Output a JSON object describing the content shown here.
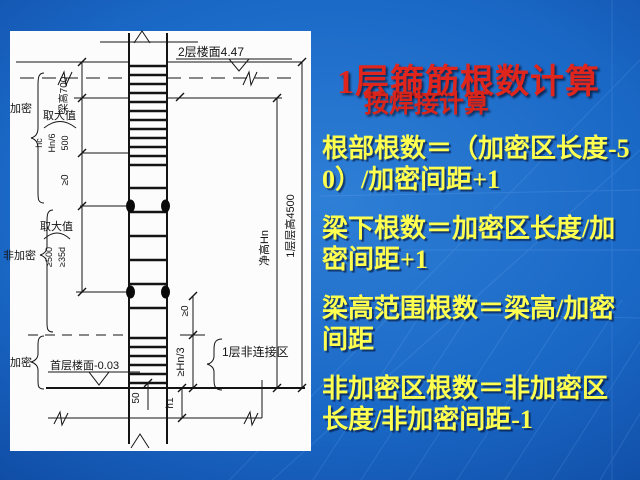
{
  "slide": {
    "title": "1层箍筋根数计算",
    "subtitle": "按焊接计算",
    "paragraphs": [
      "根部根数＝（加密区长度-50）/加密间距+1",
      "梁下根数＝加密区长度/加密间距+1",
      "梁高范围根数＝梁高/加密间距",
      "非加密区根数＝非加密区长度/非加密间距-1"
    ],
    "colors": {
      "background": "#1a68c6",
      "title_red": "#e0261c",
      "body_yellow": "#ffff4f",
      "panel_white": "#fcfcfc",
      "line_black": "#141414"
    }
  },
  "diagram": {
    "labels": {
      "floor2_level": "2层楼面4.47",
      "beam_height": "梁高700",
      "dense_top": "加密",
      "take_max_top": "取大值",
      "hc": "hc",
      "hn6": "Hn/6",
      "v500": "500",
      "ge0_left": "≥0",
      "non_dense": "非加密",
      "take_max_mid": "取大值",
      "ge500": "≥500",
      "ge35d": "≥35d",
      "dense_bottom": "加密",
      "floor1_level": "首层楼面-0.03",
      "v50": "50",
      "net_height": "净高Hn",
      "story_height": "1层层高4500",
      "ge0_right": "≥0",
      "ge_hn3": "≥Hn/3",
      "h1": "h1",
      "non_connect_zone": "1层非连接区"
    }
  }
}
